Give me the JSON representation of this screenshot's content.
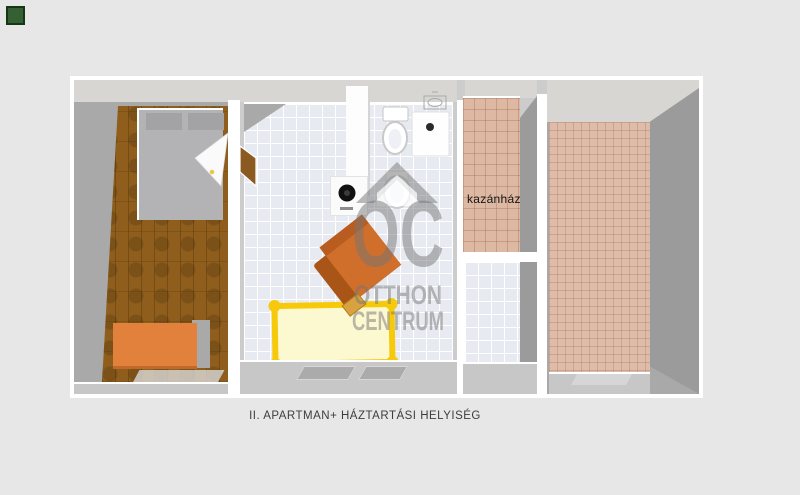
{
  "window": {
    "background": "#e7e7e7"
  },
  "corner_marker": {
    "color": "#356031",
    "border": "#16361a"
  },
  "floorplan": {
    "caption": "II. APARTMAN+ HÁZTARTÁSI HELYISÉG",
    "rooms": {
      "boiler_room_label": "kazánház"
    },
    "palette": {
      "outline_white": "#ffffff",
      "wall_gray": "#a9a9a9",
      "wall_dark": "#9b9b9b",
      "ceiling_gray": "#d7d6d3",
      "wood_floor_brown": "#8f5e1d",
      "tile_blue_white": "#e8eaf1",
      "tile_pink": "#ddb8a3",
      "bedroom_bed_gray": "#b3b3b6",
      "dresser_orange": "#e2813c",
      "chair_orange": "#cf6f2b",
      "bed_frame_yellow": "#f6c90a",
      "bed_fill_pale_yellow": "#fcf9d0",
      "washer_door_black": "#111111"
    }
  },
  "watermark": {
    "monogram": "OC",
    "line1": "OTTHON",
    "line2": "CENTRUM",
    "color": "#757575"
  }
}
